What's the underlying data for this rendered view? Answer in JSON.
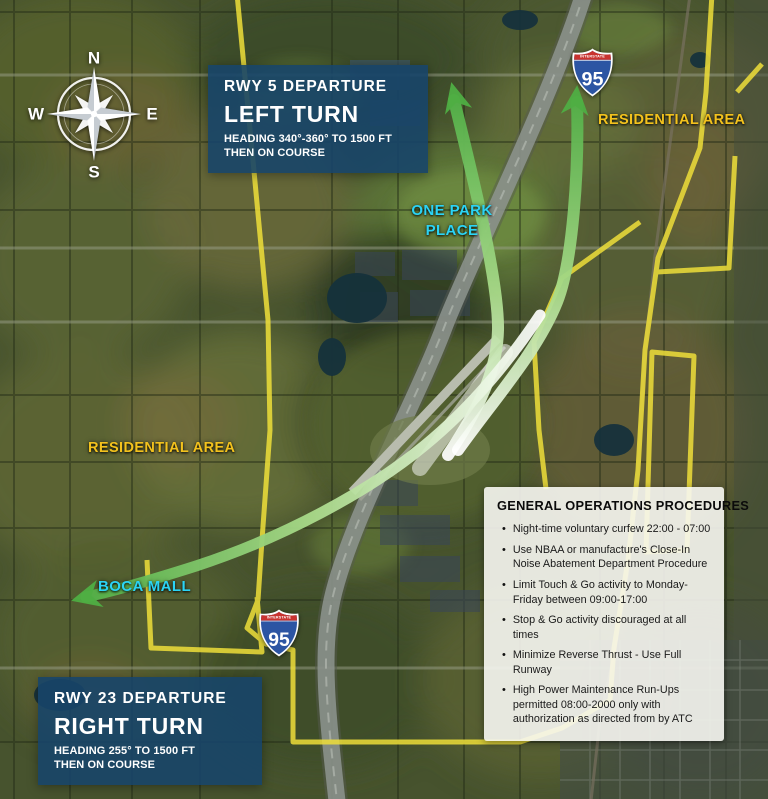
{
  "compass": {
    "n": "N",
    "e": "E",
    "s": "S",
    "w": "W"
  },
  "shields": {
    "top": {
      "band": "INTERSTATE",
      "number": "95"
    },
    "bottom": {
      "band": "INTERSTATE",
      "number": "95"
    }
  },
  "labels": {
    "residential_area_right": "RESIDENTIAL AREA",
    "residential_area_left": "RESIDENTIAL AREA",
    "one_park_place": [
      "ONE PARK",
      "PLACE"
    ],
    "boca_mall": "BOCA MALL"
  },
  "rwy5_departure": {
    "title": "RWY 5 DEPARTURE",
    "turn": "LEFT TURN",
    "heading": "HEADING 340°-360° TO 1500 FT",
    "course": "THEN ON COURSE"
  },
  "rwy23_departure": {
    "title": "RWY 23 DEPARTURE",
    "turn": "RIGHT TURN",
    "heading": "HEADING 255° TO 1500 FT",
    "course": "THEN ON COURSE"
  },
  "procedures": {
    "title": "GENERAL OPERATIONS PROCEDURES",
    "bullet_glyph": "•",
    "items": [
      "Night-time voluntary curfew 22:00 - 07:00",
      "Use NBAA or manufacture's Close-In Noise Abatement Department Procedure",
      "Limit Touch & Go activity to Monday-Friday between 09:00-17:00",
      "Stop & Go activity discouraged at all times",
      "Minimize Reverse Thrust - Use Full Runway",
      "High Power Maintenance Run-Ups permitted 08:00-2000 only with authorization as directed from by ATC"
    ]
  },
  "colors": {
    "panel_blue": "#174569",
    "label_yellow": "#f3c21d",
    "label_cyan": "#2bd4f5",
    "arrow_green": "#53b148",
    "boundary_yellow": "#efdf3a",
    "shield_red": "#c9332f",
    "shield_blue": "#2c55a3"
  }
}
